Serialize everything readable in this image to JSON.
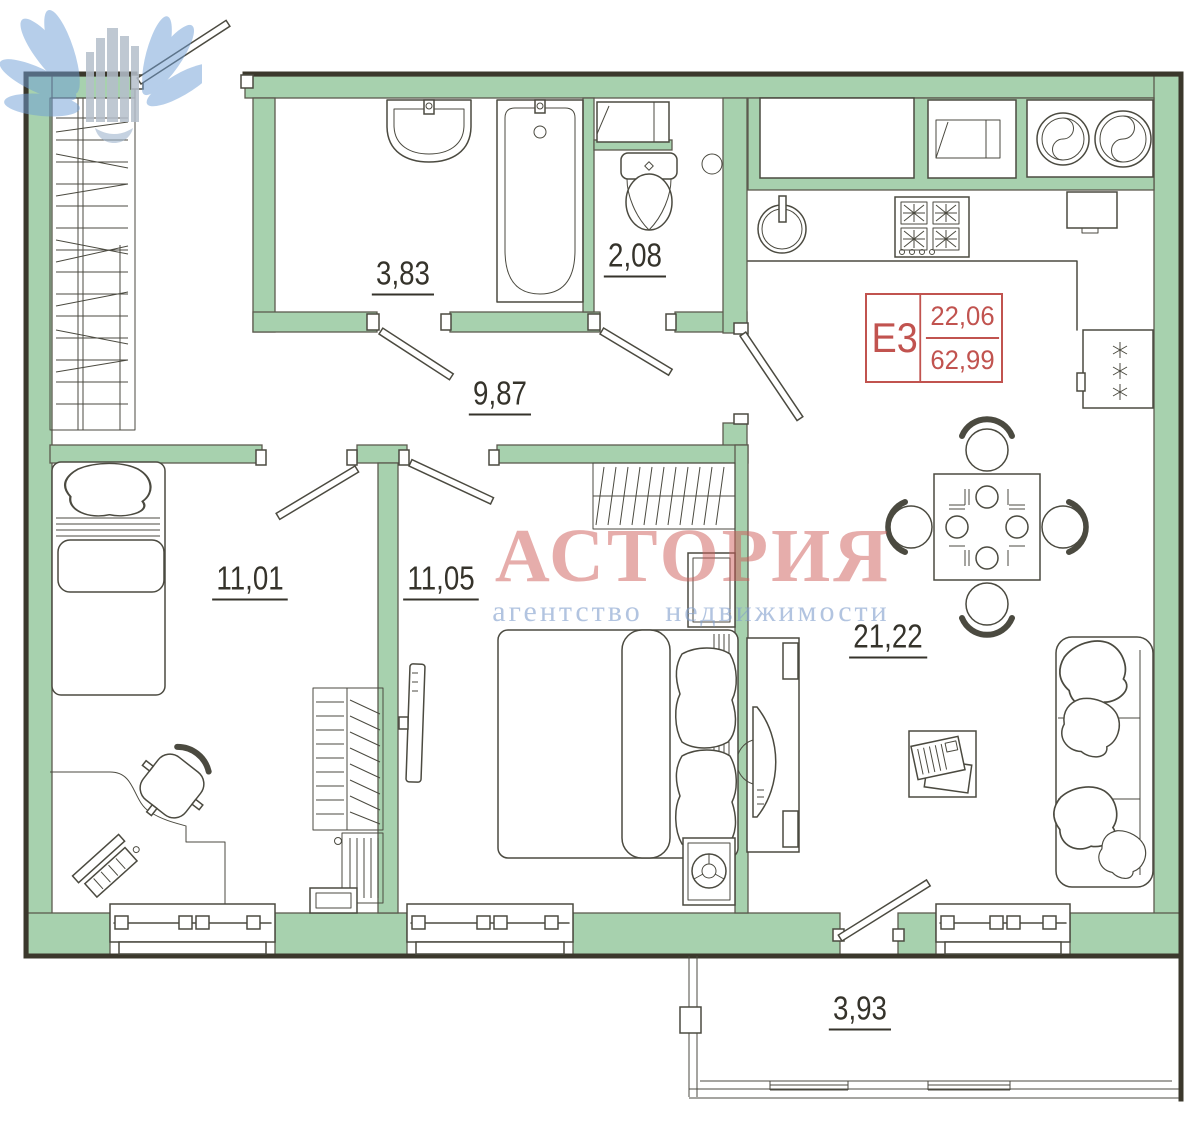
{
  "plan": {
    "unit": {
      "code": "Е3",
      "living_area": "22,06",
      "total_area": "62,99"
    },
    "rooms": {
      "bathroom": {
        "area": "3,83"
      },
      "toilet": {
        "area": "2,08"
      },
      "hallway": {
        "area": "9,87"
      },
      "bedroom_left": {
        "area": "11,01"
      },
      "bedroom_middle": {
        "area": "11,05"
      },
      "kitchen_living": {
        "area": "21,22"
      },
      "balcony": {
        "area": "3,93"
      }
    },
    "colors": {
      "wall_fill": "#a7d1ae",
      "wall_outline": "#5c5a4e",
      "outer_edge": "#3b382c",
      "line": "#4b4a40",
      "label_text": "#35332b",
      "unit_accent": "#c1534f",
      "watermark_title": "#ce5c58",
      "watermark_subtitle": "#82a0cd"
    }
  },
  "watermark": {
    "title": "АСТОРИЯ",
    "subtitle": "агентство недвижимости"
  }
}
